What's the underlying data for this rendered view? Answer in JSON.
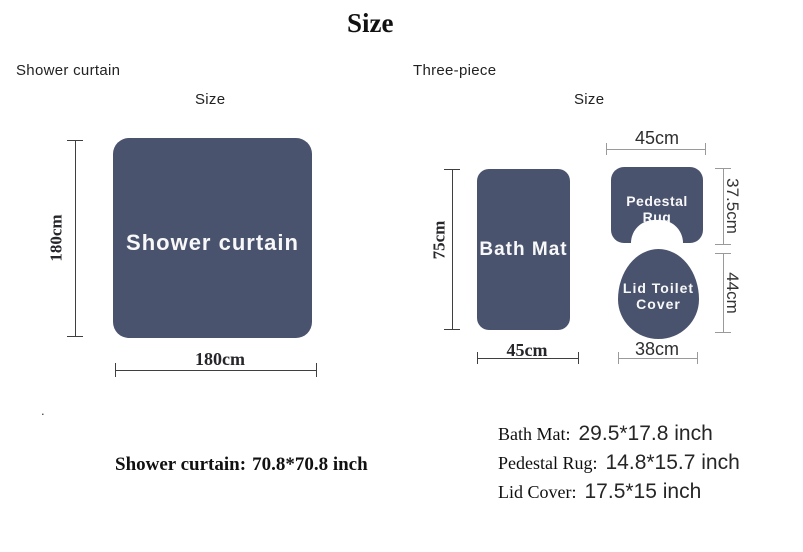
{
  "title": "Size",
  "colors": {
    "shape_fill": "#4a536e",
    "dim_line_dark": "#3f3f3f",
    "dim_line_gray": "#9a9a9a",
    "shape_text": "#f8f8f8"
  },
  "left": {
    "section_label": "Shower curtain",
    "size_label": "Size",
    "curtain": {
      "label": "Shower curtain",
      "height": "180cm",
      "width": "180cm"
    },
    "stray_dot": ".",
    "spec": {
      "name": "Shower curtain:",
      "value": "70.8*70.8 inch"
    }
  },
  "right": {
    "section_label": "Three-piece",
    "size_label": "Size",
    "bath_mat": {
      "label": "Bath Mat",
      "height": "75cm",
      "width": "45cm"
    },
    "pedestal_rug": {
      "label": "Pedestal Rug",
      "width": "45cm",
      "height": "37.5cm"
    },
    "lid_cover": {
      "label_line1": "Lid Toilet",
      "label_line2": "Cover",
      "height": "44cm",
      "width": "38cm"
    },
    "specs": [
      {
        "name": "Bath Mat:",
        "value": "29.5*17.8 inch"
      },
      {
        "name": "Pedestal Rug:",
        "value": "14.8*15.7 inch"
      },
      {
        "name": "Lid Cover:",
        "value": "17.5*15 inch"
      }
    ]
  }
}
